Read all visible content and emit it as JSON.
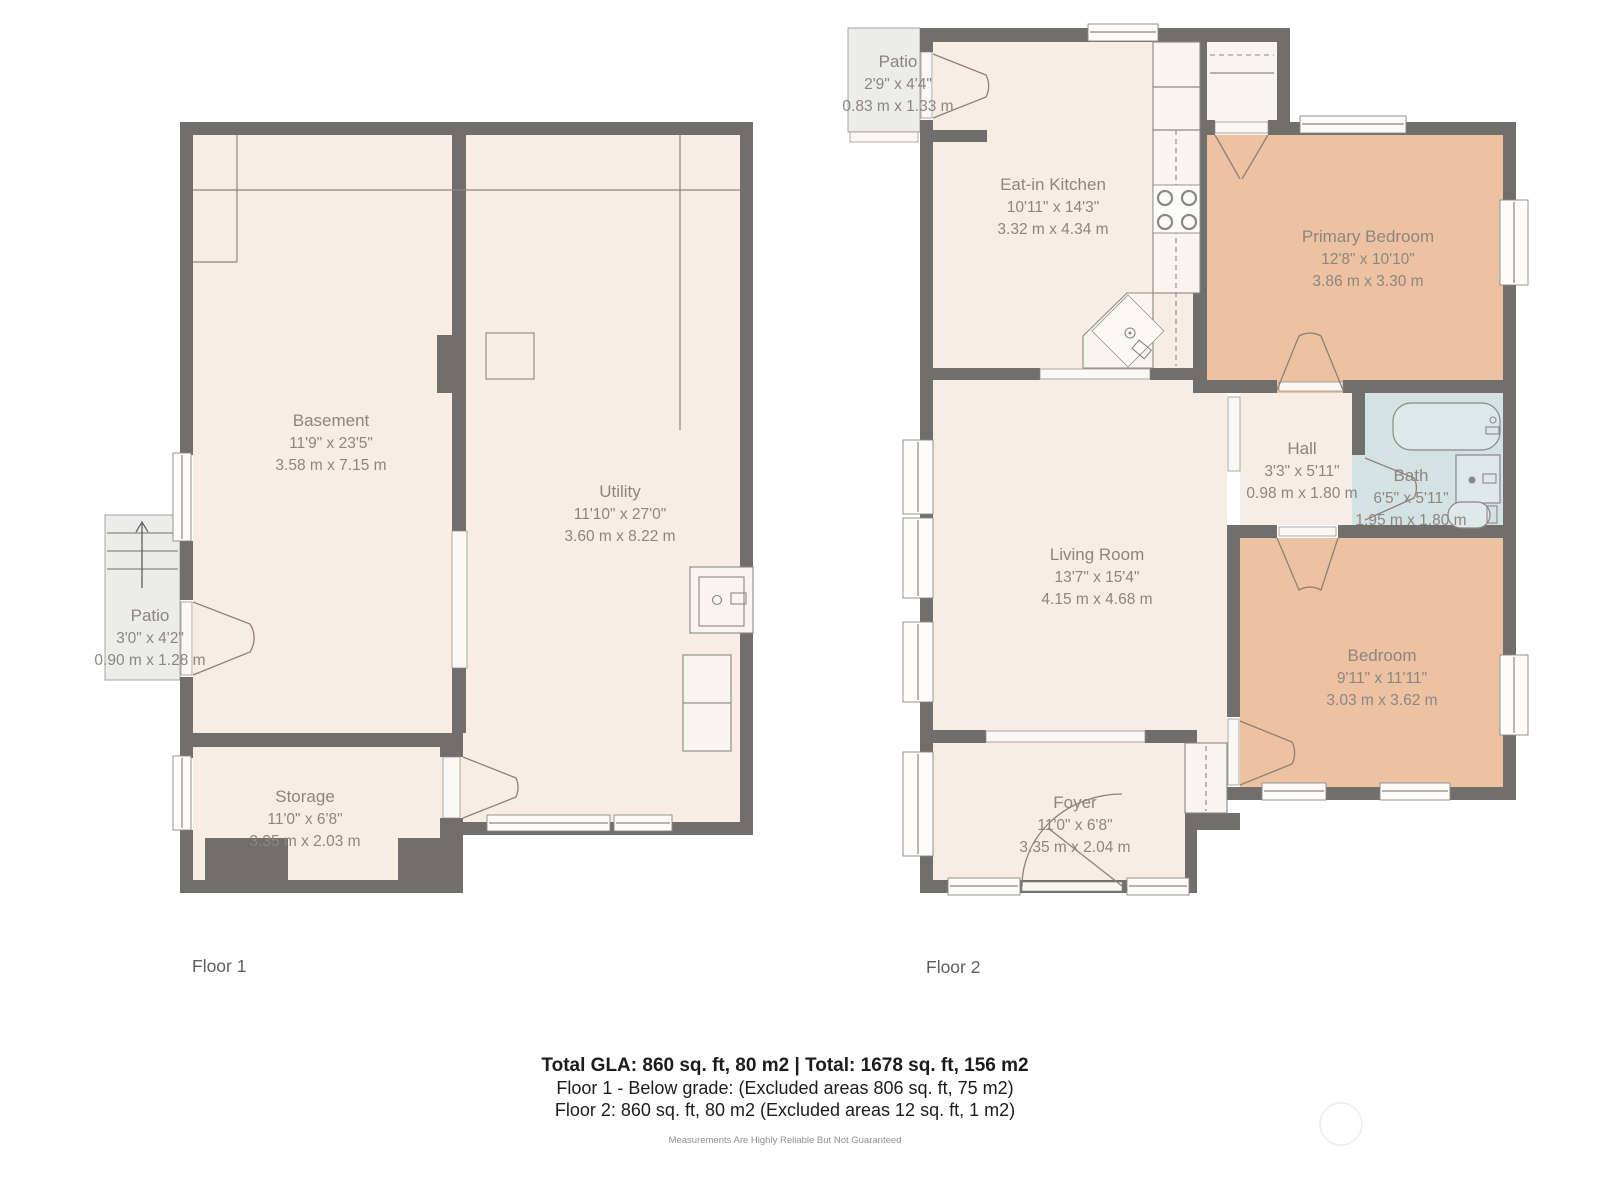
{
  "floor1": {
    "label": "Floor 1",
    "rooms": {
      "basement": {
        "name": "Basement",
        "imperial": "11'9\" x 23'5\"",
        "metric": "3.58 m x 7.15 m"
      },
      "utility": {
        "name": "Utility",
        "imperial": "11'10\" x 27'0\"",
        "metric": "3.60 m x 8.22 m"
      },
      "storage": {
        "name": "Storage",
        "imperial": "11'0\" x 6'8\"",
        "metric": "3.35 m x 2.03 m"
      },
      "patio": {
        "name": "Patio",
        "imperial": "3'0\" x 4'2\"",
        "metric": "0.90 m x 1.28 m"
      }
    }
  },
  "floor2": {
    "label": "Floor 2",
    "rooms": {
      "patio": {
        "name": "Patio",
        "imperial": "2'9\" x 4'4\"",
        "metric": "0.83 m x 1.33 m"
      },
      "kitchen": {
        "name": "Eat-in Kitchen",
        "imperial": "10'11\" x 14'3\"",
        "metric": "3.32 m x 4.34 m"
      },
      "primary_bedroom": {
        "name": "Primary Bedroom",
        "imperial": "12'8\" x 10'10\"",
        "metric": "3.86 m x 3.30 m"
      },
      "hall": {
        "name": "Hall",
        "imperial": "3'3\" x 5'11\"",
        "metric": "0.98 m x 1.80 m"
      },
      "bath": {
        "name": "Bath",
        "imperial": "6'5\" x 5'11\"",
        "metric": "1.95 m x 1.80 m"
      },
      "living_room": {
        "name": "Living Room",
        "imperial": "13'7\" x 15'4\"",
        "metric": "4.15 m x 4.68 m"
      },
      "bedroom": {
        "name": "Bedroom",
        "imperial": "9'11\" x 11'11\"",
        "metric": "3.03 m x 3.62 m"
      },
      "foyer": {
        "name": "Foyer",
        "imperial": "11'0\" x 6'8\"",
        "metric": "3.35 m x 2.04 m"
      }
    }
  },
  "footer": {
    "total": "Total GLA: 860 sq. ft, 80 m2 | Total: 1678 sq. ft, 156 m2",
    "floor1_note": "Floor 1 - Below grade: (Excluded areas 806 sq. ft, 75 m2)",
    "floor2_note": "Floor 2: 860 sq. ft, 80 m2 (Excluded areas 12 sq. ft, 1 m2)",
    "disclaimer": "Measurements Are Highly Reliable But Not Guaranteed"
  },
  "colors": {
    "wall": "#716f6c",
    "floor": "#f7ede5",
    "bedroom": "#edc2a2",
    "bath": "#d4e2e4",
    "patio": "#ececea",
    "fixture": "#f9f4ee",
    "line": "#8a8884",
    "label_text": "#8d867f"
  }
}
